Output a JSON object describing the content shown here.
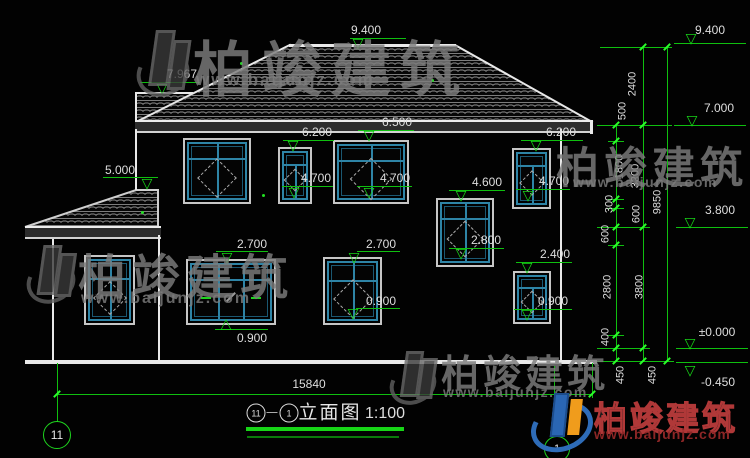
{
  "watermark": {
    "brand": "柏竣建筑",
    "url": "www.baijunjz.com"
  },
  "markers": {
    "ridge": "9.400",
    "subroof": "7.967",
    "wing": "5.000",
    "w2_top": "6.200",
    "w3_top": "6.500",
    "w5_top": "6.200",
    "w2_sill": "4.700",
    "w3_sill": "4.700",
    "w5_sill": "4.700",
    "w4_top": "4.600",
    "w4_sill": "2.800",
    "w6_top": "2.400",
    "w6_sill": "0.900",
    "w8_top": "2.700",
    "w8_sill": "0.900",
    "w9_top": "2.700",
    "w9_sill": "0.900"
  },
  "levels": {
    "l9400": "9.400",
    "l7000": "7.000",
    "l3800": "3.800",
    "l0": "±0.000",
    "lm450": "-0.450"
  },
  "dims": {
    "inner": [
      "500",
      "1800",
      "300",
      "600",
      "600",
      "2800",
      "400",
      "450"
    ],
    "middle": [
      "2400",
      "3200",
      "3800",
      "450"
    ],
    "outer": "9850",
    "total_width": "15840"
  },
  "axes": {
    "left": "11",
    "right": "1"
  },
  "title": {
    "axis_a": "11",
    "separator": "—",
    "axis_b": "1",
    "name": "立面图",
    "scale": "1:100"
  }
}
